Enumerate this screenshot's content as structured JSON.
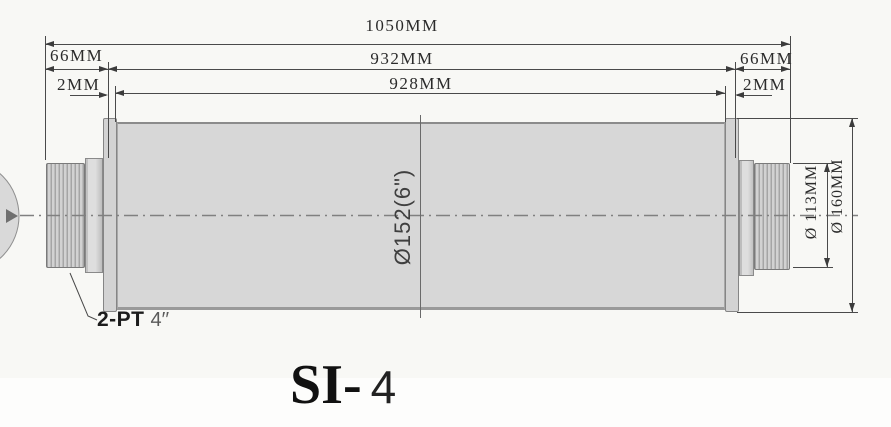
{
  "title": {
    "prefix": "SI-",
    "suffix": "4"
  },
  "dims": {
    "overall": "1050MM",
    "shell_with_gaps": "932MM",
    "shell_face": "928MM",
    "shaft_end_left": "66MM",
    "shaft_end_right": "66MM",
    "gap_left": "2MM",
    "gap_right": "2MM",
    "body_diameter": "Ø152(6\")",
    "shaft_diameter": "Ø 113MM",
    "cap_diameter": "Ø 160MM"
  },
  "labels": {
    "thread_bold": "2-PT",
    "thread_size": "4′′"
  },
  "colors": {
    "body_fill": "#d7d7d7",
    "line_ink": "#3c3c3c",
    "background": "#f8f8f5"
  }
}
